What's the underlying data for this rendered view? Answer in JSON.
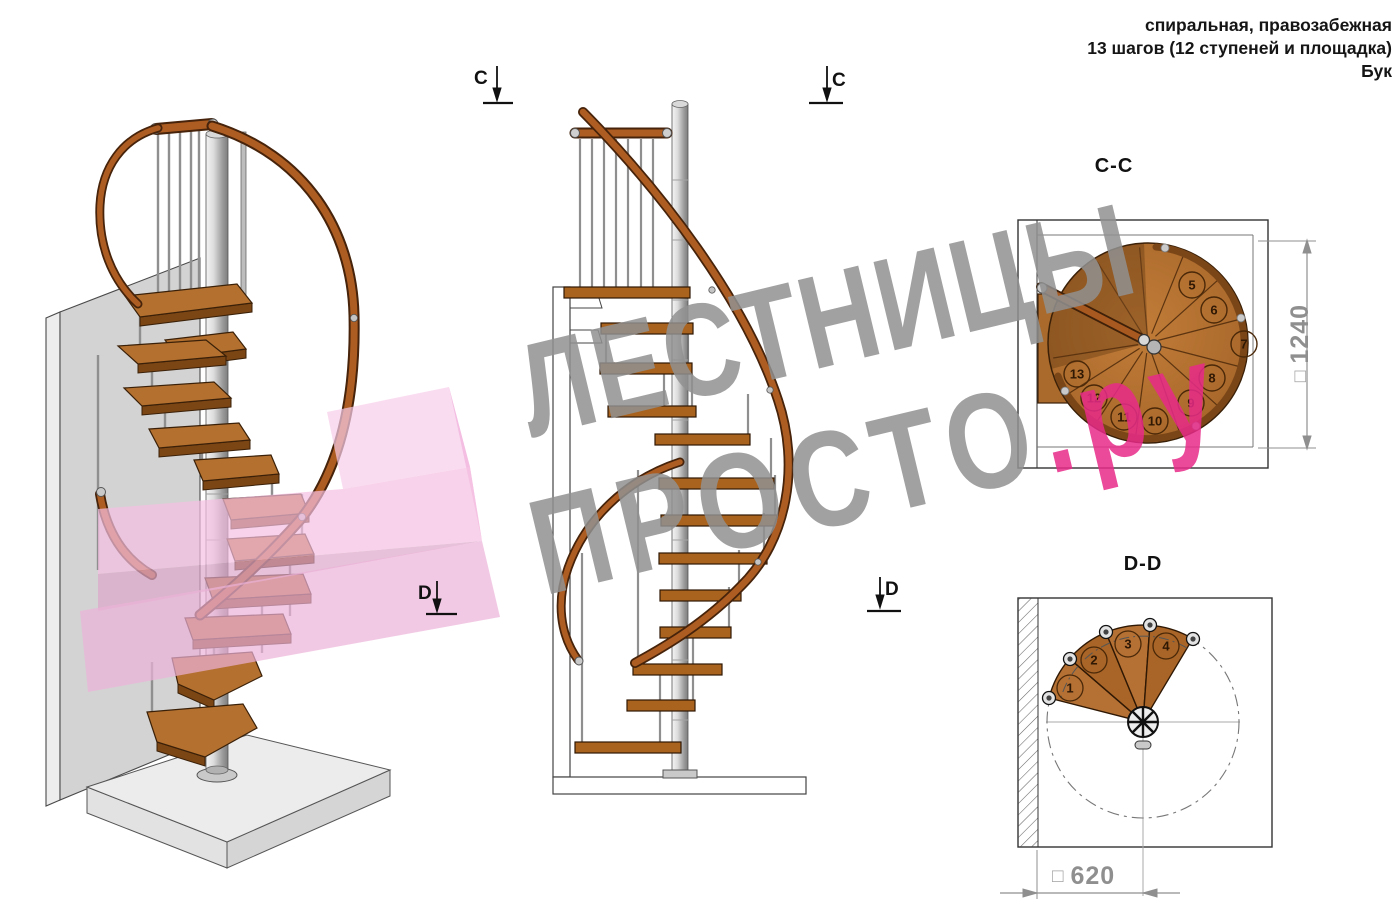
{
  "header": {
    "line1": "спиральная, правозабежная",
    "line2": "13 шагов (12 ступеней и площадка)",
    "line3": "Бук"
  },
  "section_markers": {
    "c": "C",
    "d": "D"
  },
  "views": {
    "cc": {
      "title": "C-C",
      "dimension_square": "□",
      "dimension_value": "1240",
      "step_numbers": [
        "5",
        "6",
        "7",
        "8",
        "9",
        "10",
        "11",
        "12",
        "13"
      ]
    },
    "dd": {
      "title": "D-D",
      "dimension_square": "□",
      "dimension_value": "620",
      "step_numbers": [
        "1",
        "2",
        "3",
        "4"
      ]
    }
  },
  "watermark": {
    "line1": "ЛЕСТНИЦЫ",
    "line2": "ПРОСТО",
    "line2_suffix": ".ру"
  },
  "colors": {
    "wood": "#ad6d2e",
    "wood_dark": "#7c4514",
    "rail": "#a8591f",
    "metal": "#c9c9c9",
    "outline": "#333333",
    "dim_gray": "#8f8f8f",
    "watermark_gray": "#919191",
    "watermark_pink": "#e72a88",
    "highlight_pink": "#f3bfe1"
  }
}
